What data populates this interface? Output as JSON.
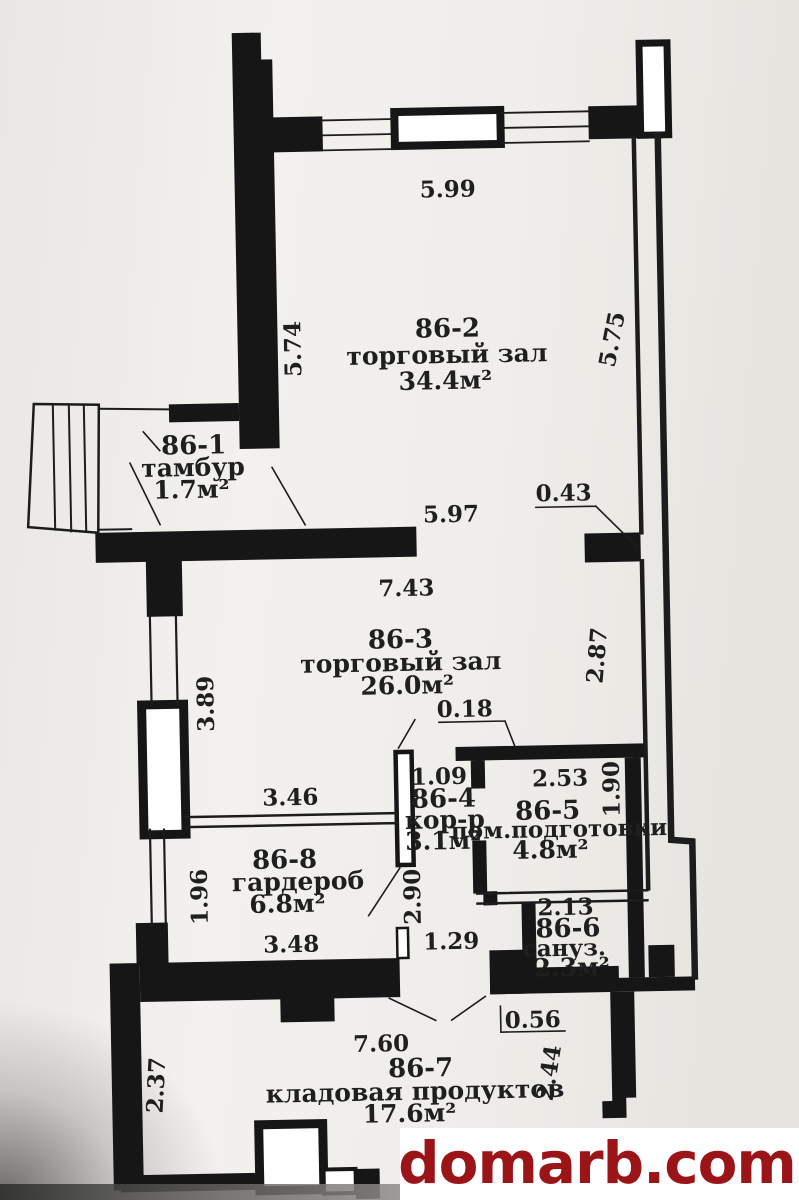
{
  "watermark": {
    "text": "domarb.com",
    "color": "#9b1418",
    "background": "#ffffff"
  },
  "plan": {
    "rooms": [
      {
        "id": "86-2",
        "name": "торговый зал",
        "area": "34.4м²"
      },
      {
        "id": "86-1",
        "name": "тамбур",
        "area": "1.7м²"
      },
      {
        "id": "86-3",
        "name": "торговый зал",
        "area": "26.0м²"
      },
      {
        "id": "86-4",
        "name": "кор-р",
        "area": "3.1м²"
      },
      {
        "id": "86-5",
        "name": "пом.подготовки",
        "area": "4.8м²"
      },
      {
        "id": "86-8",
        "name": "гардероб",
        "area": "6.8м²"
      },
      {
        "id": "86-6",
        "name": "сануз.",
        "area": "2.3м²"
      },
      {
        "id": "86-7",
        "name": "кладовая продуктов",
        "area": "17.6м²"
      }
    ],
    "dims": {
      "d599": "5.99",
      "d574": "5.74",
      "d575": "5.75",
      "d597": "5.97",
      "d043": "0.43",
      "d743": "7.43",
      "d389": "3.89",
      "d287": "2.87",
      "d018": "0.18",
      "d109": "1.09",
      "d253": "2.53",
      "d190": "1.90",
      "d346": "3.46",
      "d290": "2.90",
      "d196": "1.96",
      "d348": "3.48",
      "d213": "2.13",
      "d129": "1.29",
      "d056": "0.56",
      "d760": "7.60",
      "d237": "2.37",
      "d244": "2.44"
    },
    "colors": {
      "wall": "#161616",
      "paper": "#efedea"
    }
  }
}
